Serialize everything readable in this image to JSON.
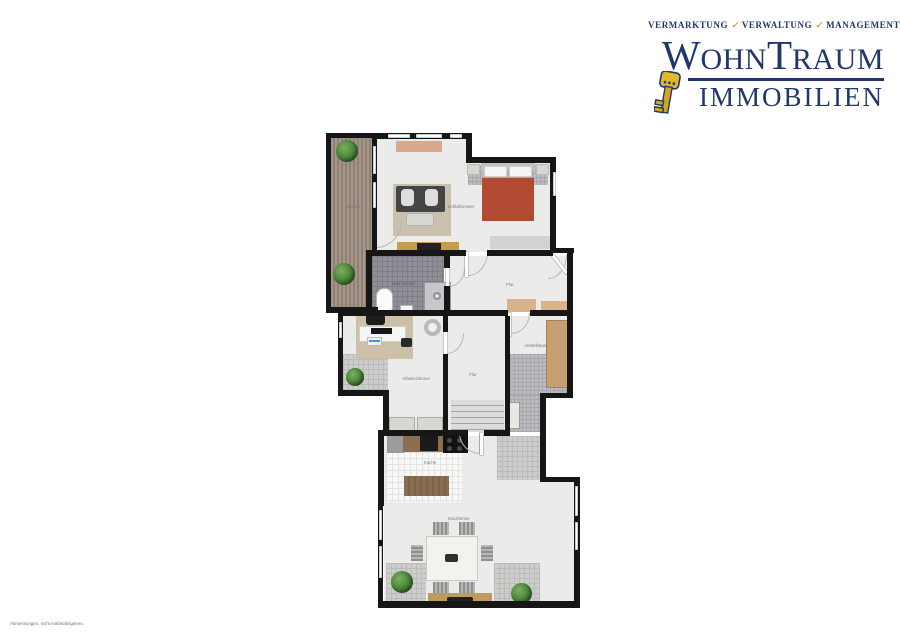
{
  "logo": {
    "tagline": [
      "VERMARKTUNG",
      "VERWALTUNG",
      "MANAGEMENT"
    ],
    "tagline_mark": "✓",
    "brand": {
      "w": "W",
      "ohn": "OHN",
      "t": "T",
      "raum": "RAUM",
      "line2": "IMMOBILIEN"
    },
    "icon": "key-icon",
    "colors": {
      "navy": "#20376e",
      "gold": "#c9a229"
    }
  },
  "floorplan": {
    "rooms": {
      "balkon": {
        "label": "Balkon"
      },
      "schlafzimmer": {
        "label": "Schlafzimmer"
      },
      "flur_oben": {
        "label": "Flur"
      },
      "bad": {
        "label": "Bad mit WC"
      },
      "arbeitszimmer": {
        "label": "Arbeitszimmer"
      },
      "flur_mitte": {
        "label": "Flur"
      },
      "abstellraum": {
        "label": "Abstellraum"
      },
      "kueche": {
        "label": "Küche"
      },
      "esszimmer": {
        "label": "Esszimmer"
      }
    },
    "watermark": "Abmessungen, nicht maßstabsgetreu"
  }
}
